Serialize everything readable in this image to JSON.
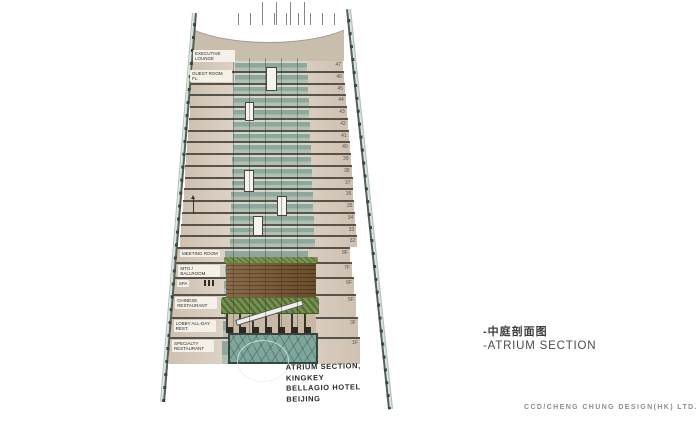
{
  "caption": {
    "cn": "-中庭剖面图",
    "en": "-ATRIUM SECTION"
  },
  "credit": {
    "text": "CCD/Cheng Chung Design(HK) LTD."
  },
  "note": {
    "lines": [
      "ATRIUM SECTION,",
      "KINGKEY",
      "BELLAGIO HOTEL",
      "BEIJING"
    ]
  },
  "section": {
    "upper_labels": [
      {
        "label": "EXECUTIVE LOUNGE"
      },
      {
        "label": "GUEST ROOM FL."
      }
    ],
    "tower_floors": [
      "47",
      "46",
      "45",
      "44",
      "43",
      "42",
      "41",
      "40",
      "39",
      "38",
      "37",
      "36",
      "35",
      "34",
      "33",
      "32"
    ],
    "podium_floors": [
      {
        "label": "MEETING ROOM",
        "num": "8F"
      },
      {
        "label": "MTG / BALLROOM",
        "num": "7F"
      },
      {
        "label": "SPA",
        "num": "6F"
      },
      {
        "label": "CHINESE RESTAURANT",
        "num": "5F"
      },
      {
        "label": "LOBBY ALL-DAY REST.",
        "num": "3F"
      },
      {
        "label": "SPECIALTY RESTAURANT",
        "num": "1F"
      }
    ],
    "elements": {
      "wood_feature_wall": "timber slat atrium wall",
      "atrium_trees": "interior tree planting",
      "escalator": "escalator",
      "entry_canopy": "glass entry canopy",
      "elevators": "atrium elevator cabs"
    },
    "colors": {
      "shell": "#cfe0d6",
      "slab": "#57524a",
      "room": "#d8cdc0",
      "glass": "#8fa89b",
      "wood": "#7d5a33",
      "tree": "#75914f",
      "base_glass": "#7ea69d",
      "roof": "#c9bdac"
    }
  }
}
